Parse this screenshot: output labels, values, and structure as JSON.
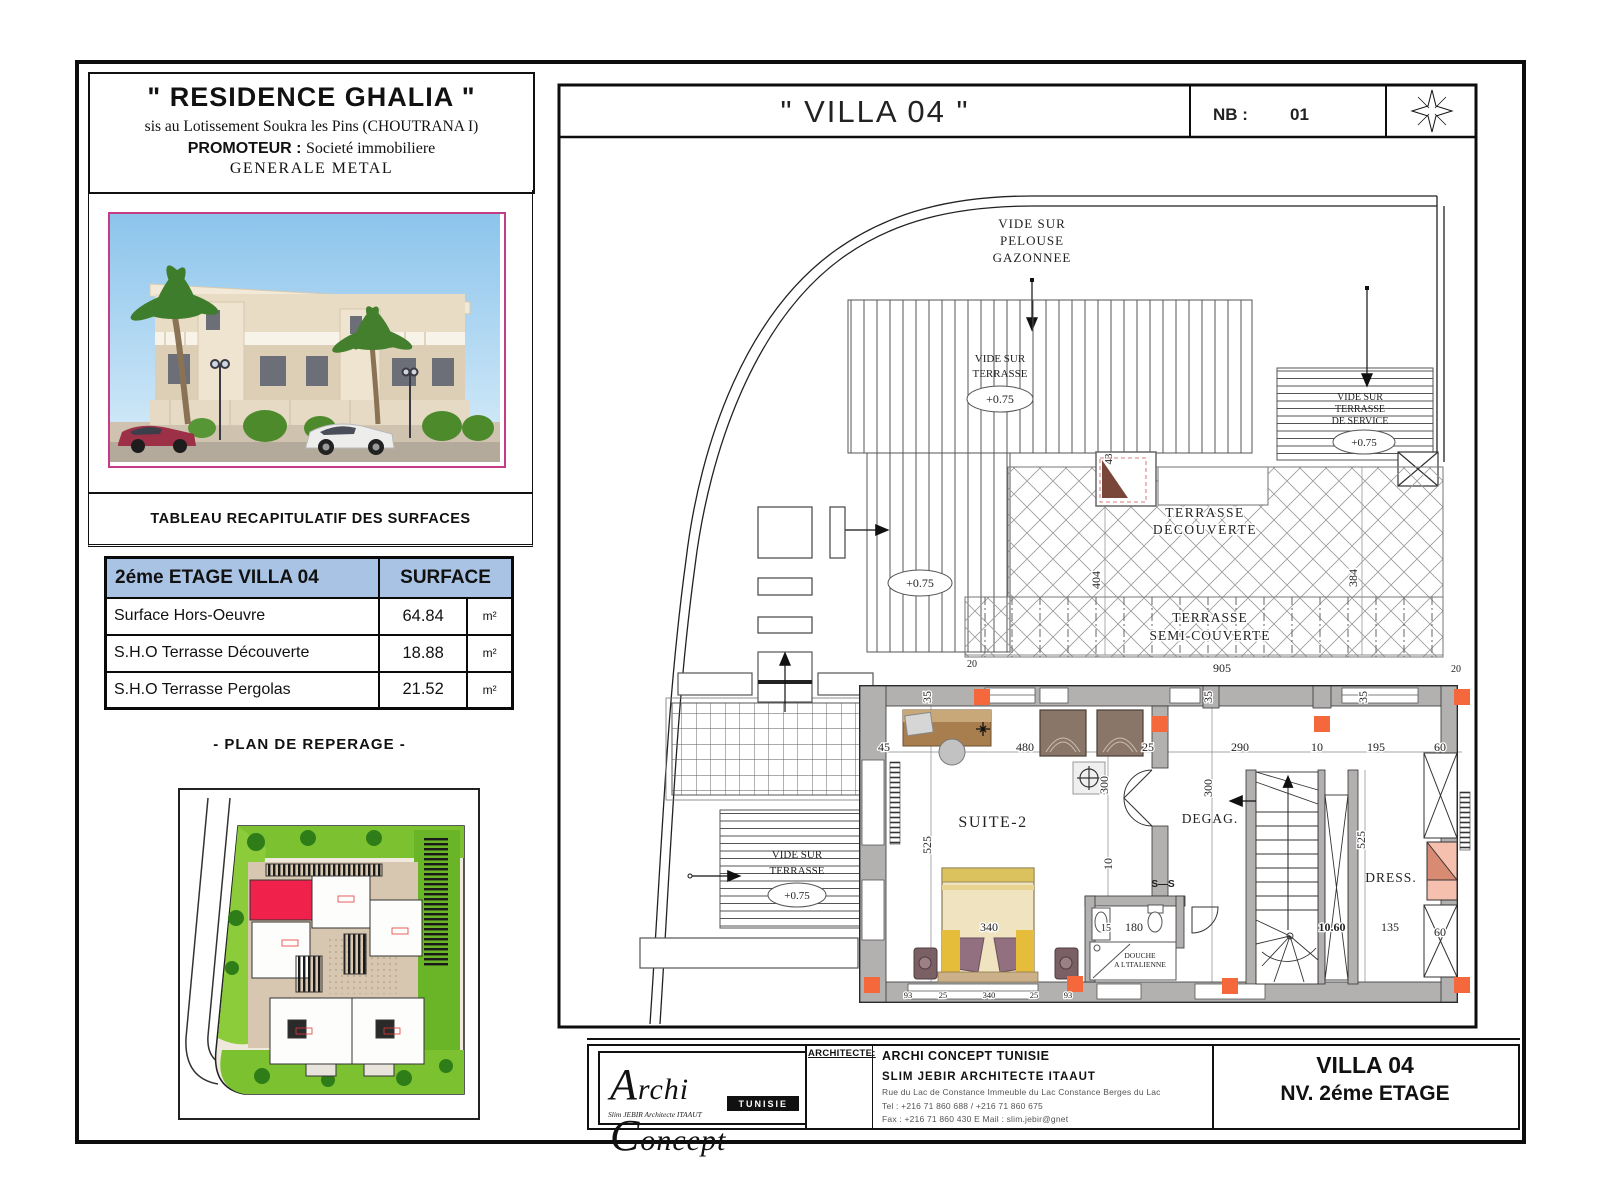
{
  "header": {
    "project_title": "\" RESIDENCE GHALIA \"",
    "location": "sis au Lotissement Soukra les Pins (CHOUTRANA I)",
    "promoter_label": "PROMOTEUR :",
    "promoter_value": "Societé immobiliere",
    "promoter_value2": "GENERALE METAL"
  },
  "surfaces_band": "TABLEAU RECAPITULATIF DES SURFACES",
  "surfaces_table": {
    "col_floor": "2éme ETAGE  VILLA 04",
    "col_surface": "SURFACE",
    "rows": [
      {
        "label": "Surface Hors-Oeuvre",
        "value": "64.84",
        "unit": "m²"
      },
      {
        "label": "S.H.O Terrasse Découverte",
        "value": "18.88",
        "unit": "m²"
      },
      {
        "label": "S.H.O Terrasse Pergolas",
        "value": "21.52",
        "unit": "m²"
      }
    ]
  },
  "reperage_title": "- PLAN DE REPERAGE -",
  "plan": {
    "title": "\" VILLA 04 \"",
    "nb_label": "NB :",
    "nb_value": "01",
    "rooms": {
      "suite": "SUITE-2",
      "degag": "DEGAG.",
      "dress": "DRESS.",
      "douche1": "DOUCHE",
      "douche2": "A L'ITALIENNE",
      "section": "S—S"
    },
    "areas": {
      "pelouse1": "VIDE SUR",
      "pelouse2": "PELOUSE",
      "pelouse3": "GAZONNEE",
      "vide1": "VIDE SUR",
      "vide2": "TERRASSE",
      "service3": "DE SERVICE",
      "tdec1": "TERRASSE",
      "tdec2": "DECOUVERTE",
      "tsc1": "TERRASSE",
      "tsc2": "SEMI-COUVERTE"
    },
    "levels": {
      "l075": "+0.75"
    },
    "dims": {
      "d43": "43",
      "d404": "404",
      "d384": "384",
      "d905": "905",
      "d20": "20",
      "d45": "45",
      "d35": "35",
      "d480": "480",
      "d25": "25",
      "d290": "290",
      "d195": "195",
      "d60": "60",
      "d300": "300",
      "d525": "525",
      "d340": "340",
      "d10": "10",
      "d15": "15",
      "d180": "180",
      "d135": "135",
      "d1060": "10.60",
      "d93": "93"
    }
  },
  "titleblock": {
    "architect_label": "ARCHITECTE:",
    "firm": "ARCHI CONCEPT TUNISIE",
    "architect": "SLIM JEBIR ARCHITECTE ITAAUT",
    "address": "Rue du Lac de Constance  Immeuble du Lac Constance Berges du Lac",
    "tel": "Tel : +216 71 860 688 / +216 71 860 675",
    "fax": "Fax : +216 71 860 430    E Mail : slim.jebir@gnet",
    "drawing1": "VILLA 04",
    "drawing2": "NV. 2éme ETAGE",
    "logo_text1": "A",
    "logo_text2": "rchi ",
    "logo_text3": "C",
    "logo_text4": "oncept",
    "logo_badge": "TUNISIE",
    "logo_sub": "Slim JEBIR Architecte ITAAUT"
  }
}
